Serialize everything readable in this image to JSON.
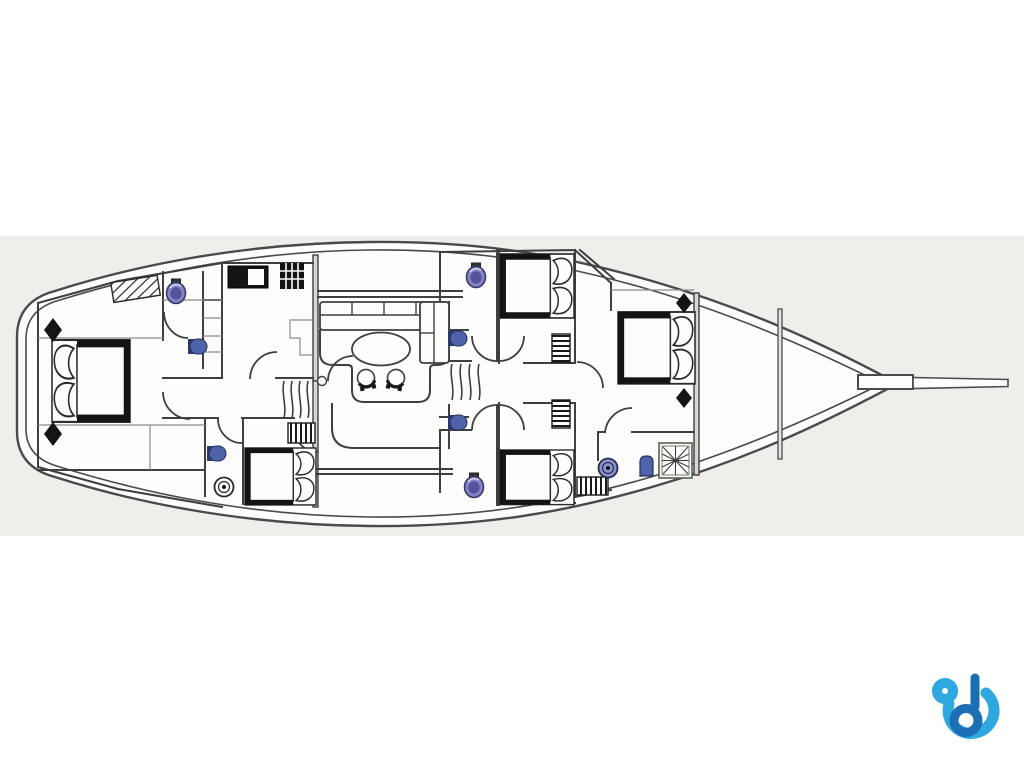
{
  "diagram": {
    "type": "yacht-deck-plan",
    "orientation": "bow-right-stern-left",
    "rooms": [
      {
        "name": "master-cabin-aft",
        "features": [
          "double-bed",
          "two-deck-hatches",
          "settee"
        ]
      },
      {
        "name": "aft-head",
        "features": [
          "toilet",
          "washbasin",
          "locker-column"
        ]
      },
      {
        "name": "galley",
        "features": [
          "stove",
          "burner-grid",
          "counter"
        ]
      },
      {
        "name": "saloon",
        "features": [
          "l-shaped-sofa",
          "oval-table",
          "two-chairs"
        ]
      },
      {
        "name": "port-aft-bathroom",
        "features": [
          "toilet-round",
          "washbasin"
        ]
      },
      {
        "name": "port-aft-cabin",
        "features": [
          "double-bed",
          "locker"
        ]
      },
      {
        "name": "midship-bathroom-fwd",
        "features": [
          "toilet",
          "washbasin"
        ]
      },
      {
        "name": "midship-cabin-fwd",
        "features": [
          "double-bed",
          "locker"
        ]
      },
      {
        "name": "midship-bathroom-aft",
        "features": [
          "toilet",
          "washbasin"
        ]
      },
      {
        "name": "midship-cabin-aft",
        "features": [
          "double-bed",
          "locker"
        ]
      },
      {
        "name": "bow-cabin",
        "features": [
          "double-bed",
          "two-deck-hatches"
        ]
      },
      {
        "name": "bow-bathroom",
        "features": [
          "toilet",
          "round-washbasin",
          "shower",
          "locker"
        ]
      },
      {
        "name": "forepeak",
        "features": []
      }
    ],
    "circulation": [
      "aft-corridor",
      "companionway-stairs-aft",
      "companionway-stairs-fwd",
      "midship-lobby"
    ],
    "hull_features": [
      "double-hull-outline",
      "transom-stern",
      "pointed-bow",
      "bowsprit",
      "bow-bulkhead",
      "forepeak-bulkhead",
      "stern-steps"
    ]
  },
  "colors": {
    "page_bg": "#ffffff",
    "plan_bg": "#efeeeb",
    "deck_white": "#fdfdfc",
    "line": "#3f3f3f",
    "furniture_black": "#141414",
    "fixture_blue": "#4e63a8",
    "fixture_blue_dark": "#2c3a6e",
    "toilet_purple": "#8583c6",
    "toilet_purple_dark": "#55549b",
    "basin_ring_blue": "#8a94cc",
    "bulkhead_gray": "#d8d8d3",
    "logo_light_blue": "#2fa8e0",
    "logo_dark_blue": "#1c6fb5"
  },
  "logo": {
    "name": "brand-logo-b",
    "shape": "stylized letter b with swirl"
  }
}
